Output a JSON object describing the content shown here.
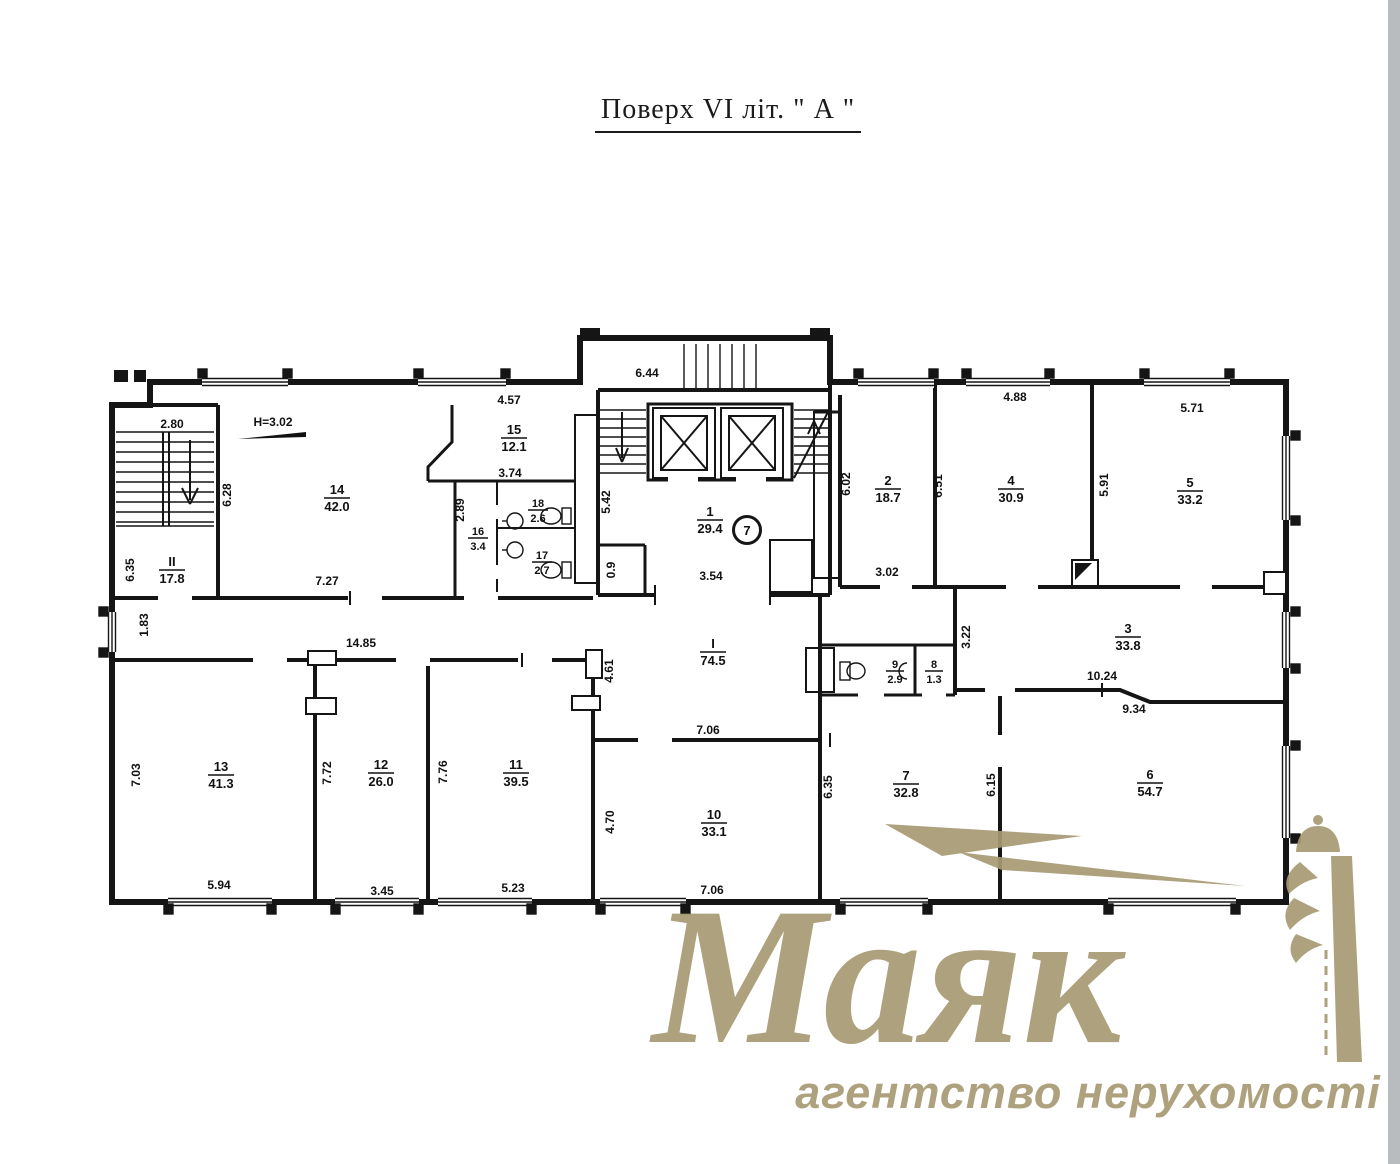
{
  "page": {
    "title": "Поверх VI  літ. \" А \""
  },
  "watermark": {
    "brand": "Маяк",
    "tagline": "агентство нерухомості",
    "color": "#a89b74"
  },
  "plan": {
    "height_note": "H=3.02",
    "entry_badge": "7",
    "rooms": {
      "c1": {
        "number": "I",
        "area": "74.5"
      },
      "c2": {
        "number": "II",
        "area": "17.8"
      },
      "r1": {
        "number": "1",
        "area": "29.4"
      },
      "r2": {
        "number": "2",
        "area": "18.7"
      },
      "r3": {
        "number": "3",
        "area": "33.8"
      },
      "r4": {
        "number": "4",
        "area": "30.9"
      },
      "r5": {
        "number": "5",
        "area": "33.2"
      },
      "r6": {
        "number": "6",
        "area": "54.7"
      },
      "r7": {
        "number": "7",
        "area": "32.8"
      },
      "r8": {
        "number": "8",
        "area": "1.3"
      },
      "r9": {
        "number": "9",
        "area": "2.9"
      },
      "r10": {
        "number": "10",
        "area": "33.1"
      },
      "r11": {
        "number": "11",
        "area": "39.5"
      },
      "r12": {
        "number": "12",
        "area": "26.0"
      },
      "r13": {
        "number": "13",
        "area": "41.3"
      },
      "r14": {
        "number": "14",
        "area": "42.0"
      },
      "r15": {
        "number": "15",
        "area": "12.1"
      },
      "r16": {
        "number": "16",
        "area": "3.4"
      },
      "r17": {
        "number": "17",
        "area": "2.7"
      },
      "r18": {
        "number": "18",
        "area": "2.6"
      }
    },
    "dims": {
      "stair_w": "2.80",
      "r14_h": "6.28",
      "rII_h": "6.35",
      "r14_w": "7.27",
      "r15_w": "4.57",
      "r15_w2": "3.74",
      "wc_h": "2.89",
      "shaft_h": "5.42",
      "lift_w": "6.44",
      "hall_w": "3.54",
      "closet_w": "0.9",
      "r2_h": "6.02",
      "r2_w": "3.02",
      "r4_h": "6.51",
      "r4_w": "4.88",
      "r5_h": "5.91",
      "r5_w": "5.71",
      "r3_h": "3.22",
      "r3_w": "10.24",
      "r6_w": "9.34",
      "corr_h": "1.83",
      "corr_w": "14.85",
      "corr_h2": "4.61",
      "r10_wt": "7.06",
      "r10_h": "4.70",
      "r10_w": "7.06",
      "r13_h": "7.03",
      "r13_w": "5.94",
      "r12_h": "7.72",
      "r12_w": "3.45",
      "r11_h": "7.76",
      "r11_w": "5.23",
      "r7_h": "6.35",
      "r7_h2": "6.15"
    }
  }
}
